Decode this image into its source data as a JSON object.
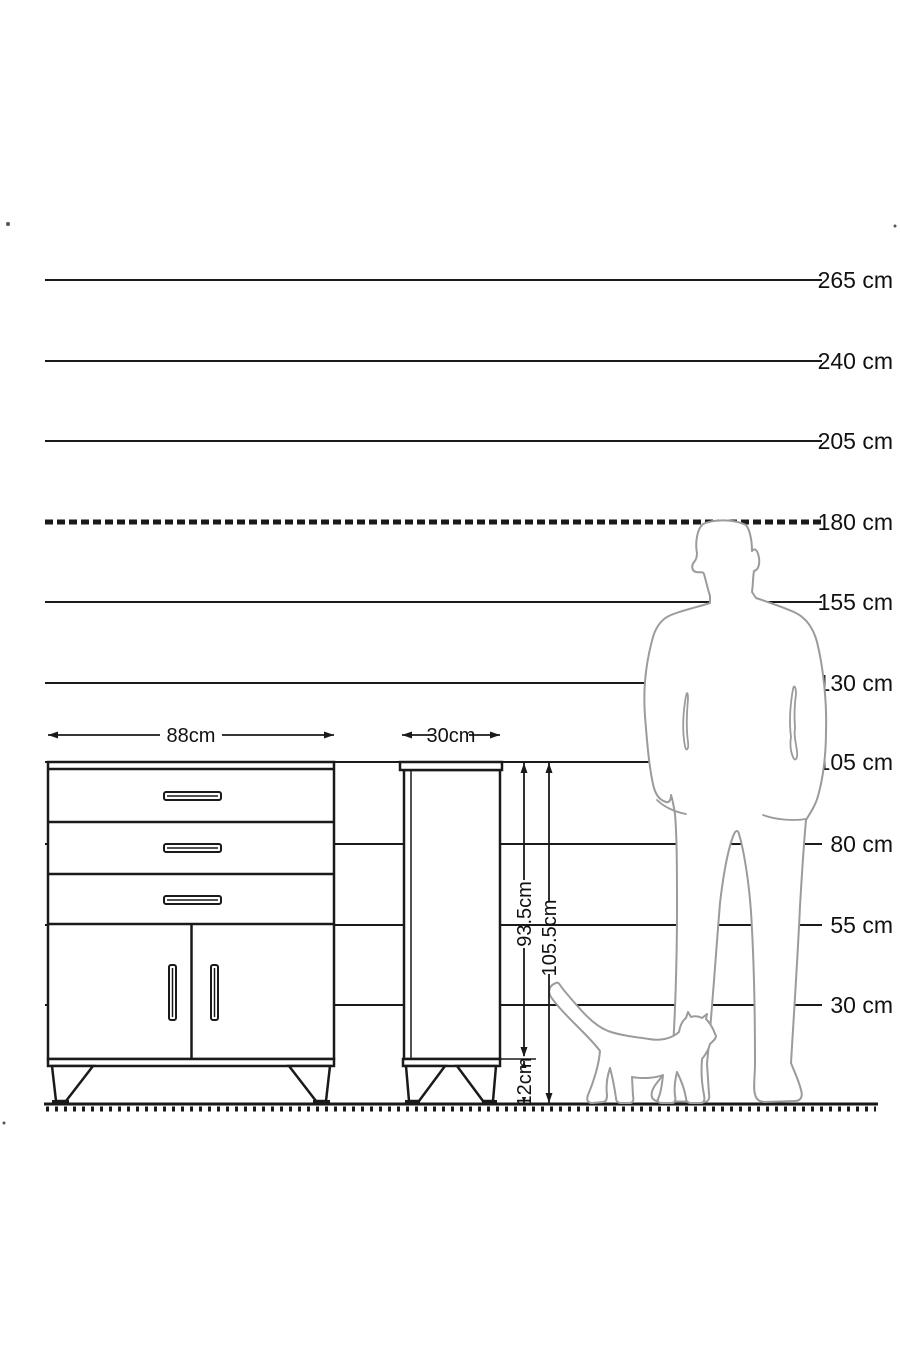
{
  "figure": {
    "type": "furniture-dimension-diagram",
    "unit": "cm"
  },
  "colors": {
    "background": "#ffffff",
    "line": "#1a1a1a",
    "text": "#111111",
    "silhouette": "#9b9b9b"
  },
  "scale": {
    "unit": "cm",
    "label_x": 893,
    "line_x1": 45,
    "line_x2": 822,
    "ground_y": 1104,
    "marks": [
      {
        "label": "265 cm",
        "value": 265,
        "y": 280,
        "style": "solid"
      },
      {
        "label": "240 cm",
        "value": 240,
        "y": 361,
        "style": "solid"
      },
      {
        "label": "205 cm",
        "value": 205,
        "y": 441,
        "style": "solid"
      },
      {
        "label": "180 cm",
        "value": 180,
        "y": 522,
        "style": "hatched"
      },
      {
        "label": "155 cm",
        "value": 155,
        "y": 602,
        "style": "solid"
      },
      {
        "label": "130 cm",
        "value": 130,
        "y": 683,
        "style": "solid"
      },
      {
        "label": "105 cm",
        "value": 105,
        "y": 762,
        "style": "solid"
      },
      {
        "label": "80 cm",
        "value": 80,
        "y": 844,
        "style": "solid"
      },
      {
        "label": "55 cm",
        "value": 55,
        "y": 925,
        "style": "solid"
      },
      {
        "label": "30 cm",
        "value": 30,
        "y": 1005,
        "style": "solid"
      }
    ]
  },
  "dimensions": {
    "dresser_width": "88cm",
    "cabinet_width": "30cm",
    "cabinet_body_height": "93.5cm",
    "cabinet_total_height": "105.5cm",
    "leg_height": "12cm"
  },
  "silhouettes": {
    "man": "man-silhouette",
    "cat": "cat-silhouette"
  }
}
